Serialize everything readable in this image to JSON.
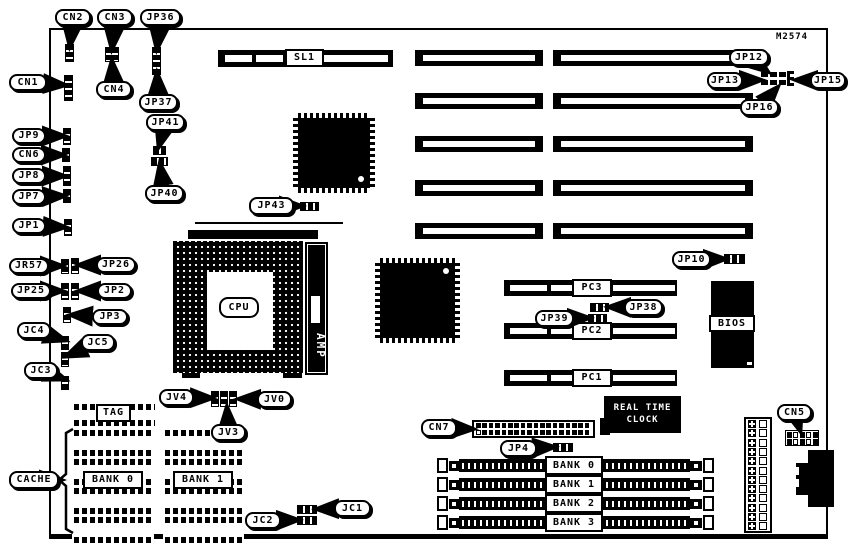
{
  "board": {
    "ref": "M2574"
  },
  "cpu": {
    "label": "CPU",
    "amp_label": "AMP"
  },
  "bios": {
    "label": "BIOS"
  },
  "rtc": {
    "line1": "REAL TIME",
    "line2": "CLOCK"
  },
  "cache": {
    "tag_label": "TAG",
    "bank0_label": "BANK 0",
    "bank1_label": "BANK 1"
  },
  "slots": {
    "sl1_label": "SL1",
    "pci": [
      {
        "label": "PC3",
        "x": 504,
        "y": 280
      },
      {
        "label": "PC2",
        "x": 504,
        "y": 323
      },
      {
        "label": "PC1",
        "x": 504,
        "y": 370
      }
    ],
    "isa_rows": [
      50,
      93,
      136,
      180,
      223
    ],
    "isa_cols": [
      {
        "x": 415,
        "w": 128
      },
      {
        "x": 553,
        "w": 200
      }
    ]
  },
  "simm": {
    "labels": [
      "BANK 0",
      "BANK 1",
      "BANK 2",
      "BANK 3"
    ],
    "rows_y": [
      456,
      475,
      494,
      513
    ]
  },
  "qfp_chips": [
    {
      "x": 293,
      "y": 113,
      "w": 82,
      "h": 80,
      "dot": "br"
    },
    {
      "x": 375,
      "y": 258,
      "w": 85,
      "h": 85,
      "dot": "tr"
    }
  ],
  "cache_chips": {
    "tag": {
      "x": 72,
      "y": 403,
      "w": 85,
      "h": 24
    },
    "cols": [
      {
        "x": 72,
        "w": 82
      },
      {
        "x": 163,
        "w": 81
      }
    ],
    "rows_y": [
      429,
      458,
      487,
      516
    ],
    "chip_h": 28
  },
  "callouts": [
    {
      "id": "cn2",
      "label": "CN2",
      "x": 55,
      "y": 9,
      "w": 36,
      "h": 17,
      "tx": 70,
      "ty": 45
    },
    {
      "id": "cn3",
      "label": "CN3",
      "x": 97,
      "y": 9,
      "w": 36,
      "h": 17,
      "tx": 112,
      "ty": 48
    },
    {
      "id": "jp36",
      "label": "JP36",
      "x": 140,
      "y": 9,
      "w": 41,
      "h": 17,
      "tx": 157,
      "ty": 48
    },
    {
      "id": "cn1",
      "label": "CN1",
      "x": 9,
      "y": 74,
      "w": 38,
      "h": 17,
      "tx": 64,
      "ty": 85
    },
    {
      "id": "cn4",
      "label": "CN4",
      "x": 96,
      "y": 81,
      "w": 36,
      "h": 17,
      "tx": 112,
      "ty": 62
    },
    {
      "id": "jp37",
      "label": "JP37",
      "x": 139,
      "y": 94,
      "w": 39,
      "h": 17,
      "tx": 157,
      "ty": 74
    },
    {
      "id": "jp41",
      "label": "JP41",
      "x": 146,
      "y": 114,
      "w": 39,
      "h": 17,
      "tx": 159,
      "ty": 146
    },
    {
      "id": "jp40",
      "label": "JP40",
      "x": 145,
      "y": 185,
      "w": 39,
      "h": 17,
      "tx": 160,
      "ty": 165
    },
    {
      "id": "jp9",
      "label": "JP9",
      "x": 12,
      "y": 128,
      "w": 34,
      "h": 16,
      "tx": 63,
      "ty": 136
    },
    {
      "id": "cn6",
      "label": "CN6",
      "x": 12,
      "y": 147,
      "w": 34,
      "h": 16,
      "tx": 62,
      "ty": 155
    },
    {
      "id": "jp8",
      "label": "JP8",
      "x": 12,
      "y": 168,
      "w": 34,
      "h": 16,
      "tx": 63,
      "ty": 176
    },
    {
      "id": "jp7",
      "label": "JP7",
      "x": 12,
      "y": 189,
      "w": 34,
      "h": 16,
      "tx": 63,
      "ty": 196
    },
    {
      "id": "jp1",
      "label": "JP1",
      "x": 12,
      "y": 218,
      "w": 34,
      "h": 16,
      "tx": 64,
      "ty": 227
    },
    {
      "id": "jr57",
      "label": "JR57",
      "x": 9,
      "y": 258,
      "w": 40,
      "h": 16,
      "tx": 61,
      "ty": 266
    },
    {
      "id": "jp26",
      "label": "JP26",
      "x": 96,
      "y": 257,
      "w": 40,
      "h": 16,
      "tx": 80,
      "ty": 265
    },
    {
      "id": "jp25",
      "label": "JP25",
      "x": 11,
      "y": 283,
      "w": 40,
      "h": 16,
      "tx": 61,
      "ty": 291
    },
    {
      "id": "jp2",
      "label": "JP2",
      "x": 97,
      "y": 283,
      "w": 35,
      "h": 16,
      "tx": 80,
      "ty": 291
    },
    {
      "id": "jp3",
      "label": "JP3",
      "x": 92,
      "y": 309,
      "w": 36,
      "h": 16,
      "tx": 72,
      "ty": 315
    },
    {
      "id": "jc4",
      "label": "JC4",
      "x": 17,
      "y": 322,
      "w": 34,
      "h": 17,
      "tx": 64,
      "ty": 340
    },
    {
      "id": "jc5",
      "label": "JC5",
      "x": 81,
      "y": 334,
      "w": 34,
      "h": 17,
      "tx": 67,
      "ty": 356
    },
    {
      "id": "jc3",
      "label": "JC3",
      "x": 24,
      "y": 362,
      "w": 34,
      "h": 17,
      "tx": 64,
      "ty": 379
    },
    {
      "id": "cache",
      "label": "CACHE",
      "x": 9,
      "y": 471,
      "w": 50,
      "h": 18,
      "tx": 60,
      "ty": 480
    },
    {
      "id": "jp43",
      "label": "JP43",
      "x": 249,
      "y": 197,
      "w": 45,
      "h": 18,
      "tx": 300,
      "ty": 206
    },
    {
      "id": "jp12",
      "label": "JP12",
      "x": 729,
      "y": 49,
      "w": 40,
      "h": 17,
      "tx": 767,
      "ty": 71
    },
    {
      "id": "jp13",
      "label": "JP13",
      "x": 707,
      "y": 72,
      "w": 36,
      "h": 17,
      "tx": 760,
      "ty": 80
    },
    {
      "id": "jp15",
      "label": "JP15",
      "x": 810,
      "y": 72,
      "w": 36,
      "h": 17,
      "tx": 797,
      "ty": 80
    },
    {
      "id": "jp16",
      "label": "JP16",
      "x": 740,
      "y": 99,
      "w": 39,
      "h": 17,
      "tx": 777,
      "ty": 88
    },
    {
      "id": "jp10",
      "label": "JP10",
      "x": 672,
      "y": 251,
      "w": 39,
      "h": 17,
      "tx": 724,
      "ty": 259
    },
    {
      "id": "jp38",
      "label": "JP38",
      "x": 624,
      "y": 299,
      "w": 39,
      "h": 17,
      "tx": 610,
      "ty": 307
    },
    {
      "id": "jp39",
      "label": "JP39",
      "x": 535,
      "y": 310,
      "w": 39,
      "h": 17,
      "tx": 588,
      "ty": 318
    },
    {
      "id": "cn7",
      "label": "CN7",
      "x": 421,
      "y": 419,
      "w": 36,
      "h": 18,
      "tx": 472,
      "ty": 429
    },
    {
      "id": "jp4",
      "label": "JP4",
      "x": 500,
      "y": 440,
      "w": 37,
      "h": 17,
      "tx": 553,
      "ty": 447
    },
    {
      "id": "jc1",
      "label": "JC1",
      "x": 334,
      "y": 500,
      "w": 37,
      "h": 17,
      "tx": 318,
      "ty": 509
    },
    {
      "id": "jc2",
      "label": "JC2",
      "x": 245,
      "y": 512,
      "w": 36,
      "h": 17,
      "tx": 297,
      "ty": 520
    },
    {
      "id": "jv4",
      "label": "JV4",
      "x": 159,
      "y": 389,
      "w": 35,
      "h": 17,
      "tx": 211,
      "ty": 398
    },
    {
      "id": "jv0",
      "label": "JV0",
      "x": 257,
      "y": 391,
      "w": 35,
      "h": 17,
      "tx": 240,
      "ty": 399
    },
    {
      "id": "jv3",
      "label": "JV3",
      "x": 211,
      "y": 424,
      "w": 35,
      "h": 17,
      "tx": 227,
      "ty": 408
    },
    {
      "id": "cn5",
      "label": "CN5",
      "x": 777,
      "y": 404,
      "w": 35,
      "h": 17,
      "tx": 800,
      "ty": 430
    }
  ],
  "jumper_blocks": [
    {
      "x": 65,
      "y": 44,
      "w": 9,
      "h": 18,
      "o": "v"
    },
    {
      "x": 105,
      "y": 47,
      "w": 14,
      "h": 15,
      "o": "v"
    },
    {
      "x": 152,
      "y": 47,
      "w": 9,
      "h": 28,
      "o": "v"
    },
    {
      "x": 64,
      "y": 75,
      "w": 9,
      "h": 26,
      "o": "v"
    },
    {
      "x": 153,
      "y": 146,
      "w": 13,
      "h": 9,
      "o": "h"
    },
    {
      "x": 151,
      "y": 157,
      "w": 17,
      "h": 9,
      "o": "h"
    },
    {
      "x": 63,
      "y": 128,
      "w": 8,
      "h": 17,
      "o": "v"
    },
    {
      "x": 62,
      "y": 148,
      "w": 8,
      "h": 14,
      "o": "v"
    },
    {
      "x": 63,
      "y": 166,
      "w": 8,
      "h": 20,
      "o": "v"
    },
    {
      "x": 63,
      "y": 189,
      "w": 8,
      "h": 14,
      "o": "v"
    },
    {
      "x": 64,
      "y": 219,
      "w": 8,
      "h": 17,
      "o": "v"
    },
    {
      "x": 61,
      "y": 259,
      "w": 8,
      "h": 15,
      "o": "v"
    },
    {
      "x": 71,
      "y": 258,
      "w": 8,
      "h": 16,
      "o": "v"
    },
    {
      "x": 61,
      "y": 283,
      "w": 8,
      "h": 17,
      "o": "v"
    },
    {
      "x": 71,
      "y": 283,
      "w": 8,
      "h": 17,
      "o": "v"
    },
    {
      "x": 63,
      "y": 307,
      "w": 8,
      "h": 16,
      "o": "v"
    },
    {
      "x": 61,
      "y": 336,
      "w": 8,
      "h": 14,
      "o": "v"
    },
    {
      "x": 61,
      "y": 352,
      "w": 8,
      "h": 15,
      "o": "v"
    },
    {
      "x": 61,
      "y": 376,
      "w": 8,
      "h": 14,
      "o": "v"
    },
    {
      "x": 300,
      "y": 202,
      "w": 19,
      "h": 9,
      "o": "h"
    },
    {
      "x": 724,
      "y": 254,
      "w": 21,
      "h": 10,
      "o": "h"
    },
    {
      "x": 590,
      "y": 303,
      "w": 19,
      "h": 9,
      "o": "h"
    },
    {
      "x": 588,
      "y": 314,
      "w": 19,
      "h": 9,
      "o": "h"
    },
    {
      "x": 553,
      "y": 443,
      "w": 20,
      "h": 9,
      "o": "h"
    },
    {
      "x": 297,
      "y": 505,
      "w": 20,
      "h": 9,
      "o": "h"
    },
    {
      "x": 297,
      "y": 516,
      "w": 20,
      "h": 9,
      "o": "h"
    },
    {
      "x": 211,
      "y": 391,
      "w": 8,
      "h": 16,
      "o": "v"
    },
    {
      "x": 220,
      "y": 391,
      "w": 8,
      "h": 16,
      "o": "v"
    },
    {
      "x": 229,
      "y": 391,
      "w": 8,
      "h": 16,
      "o": "v"
    }
  ]
}
